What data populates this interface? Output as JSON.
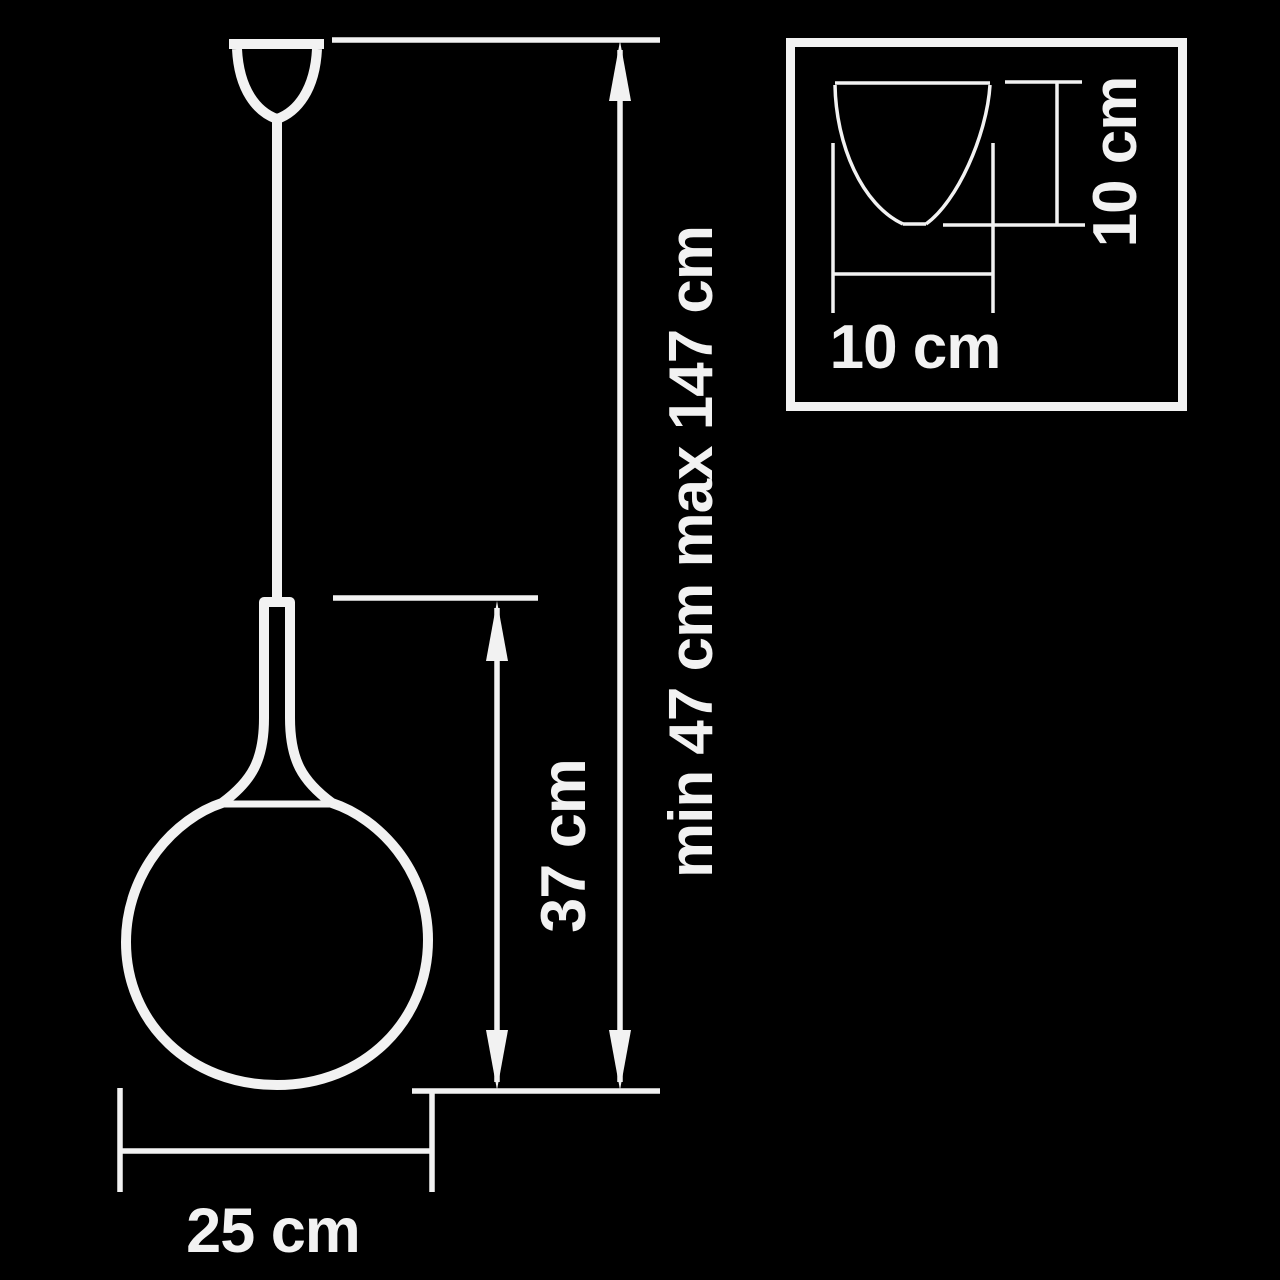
{
  "colors": {
    "background": "#000000",
    "line": "#f2f2f2"
  },
  "diagram": {
    "title_semantic": "pendant lamp dimension drawing",
    "overall_height_label": "min 47 cm max 147 cm",
    "body_height_label": "37 cm",
    "shade_diameter_label": "25 cm",
    "canopy_inset": {
      "height_label": "10 cm",
      "width_label": "10 cm"
    }
  }
}
